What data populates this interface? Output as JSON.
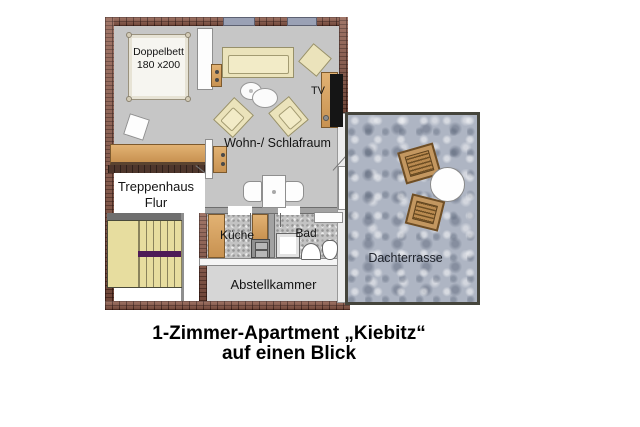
{
  "title": {
    "line1": "1-Zimmer-Apartment „Kiebitz“",
    "line2": "auf einen Blick"
  },
  "rooms": {
    "living": {
      "label": "Wohn-/ Schlafraum"
    },
    "hall": {
      "label_line1": "Treppenhaus",
      "label_line2": "Flur"
    },
    "kitchen": {
      "label": "Küche"
    },
    "bath": {
      "label": "Bad"
    },
    "storage": {
      "label": "Abstellkammer"
    },
    "terrace": {
      "label": "Dachterrasse"
    }
  },
  "furniture": {
    "bed": {
      "label_line1": "Doppelbett",
      "label_line2": "180 x200"
    },
    "tv": {
      "label": "TV"
    }
  },
  "colors": {
    "brick_wall": "#8d5847",
    "interior_wall_gray": "#a2a2a2",
    "floor_gray": "#c6c6c6",
    "tile_gray": "#c3c3c3",
    "storage_gray": "#d6d6d6",
    "terrace_blue_gray": "#aeb5c3",
    "wood": "#d1a05e",
    "upholstery_cream": "#ebe3bb",
    "stairs_yellow": "#e7dd9f",
    "stairs_landing_purple": "#4d1a57",
    "window_blue_gray": "#9aa1b5",
    "tv_black": "#151515"
  }
}
